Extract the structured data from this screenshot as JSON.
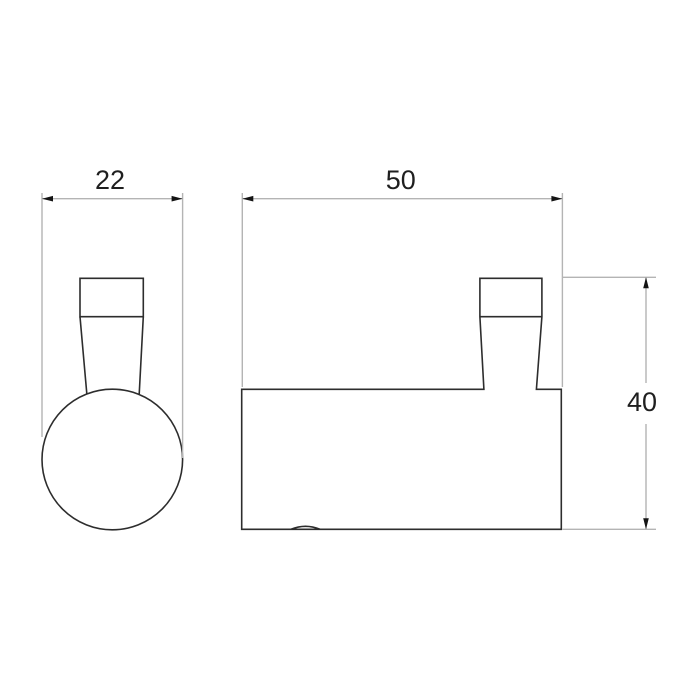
{
  "diagram": {
    "kind": "technical-drawing",
    "subject": "wall hook, two orthographic views",
    "views": [
      {
        "name": "front-view",
        "description": "round knob with tapered stem and mounting plate cap"
      },
      {
        "name": "side-view",
        "description": "hook body profile with tapered stem and cap"
      }
    ],
    "dimensions": {
      "front_width": {
        "label": "22"
      },
      "side_width": {
        "label": "50"
      },
      "side_height": {
        "label": "40"
      }
    },
    "colors": {
      "background": "#ffffff",
      "outline": "#2d2d2d",
      "dimension_line": "#b4b4b4",
      "arrowhead": "#141414",
      "label_text": "#1f1f1f"
    }
  }
}
